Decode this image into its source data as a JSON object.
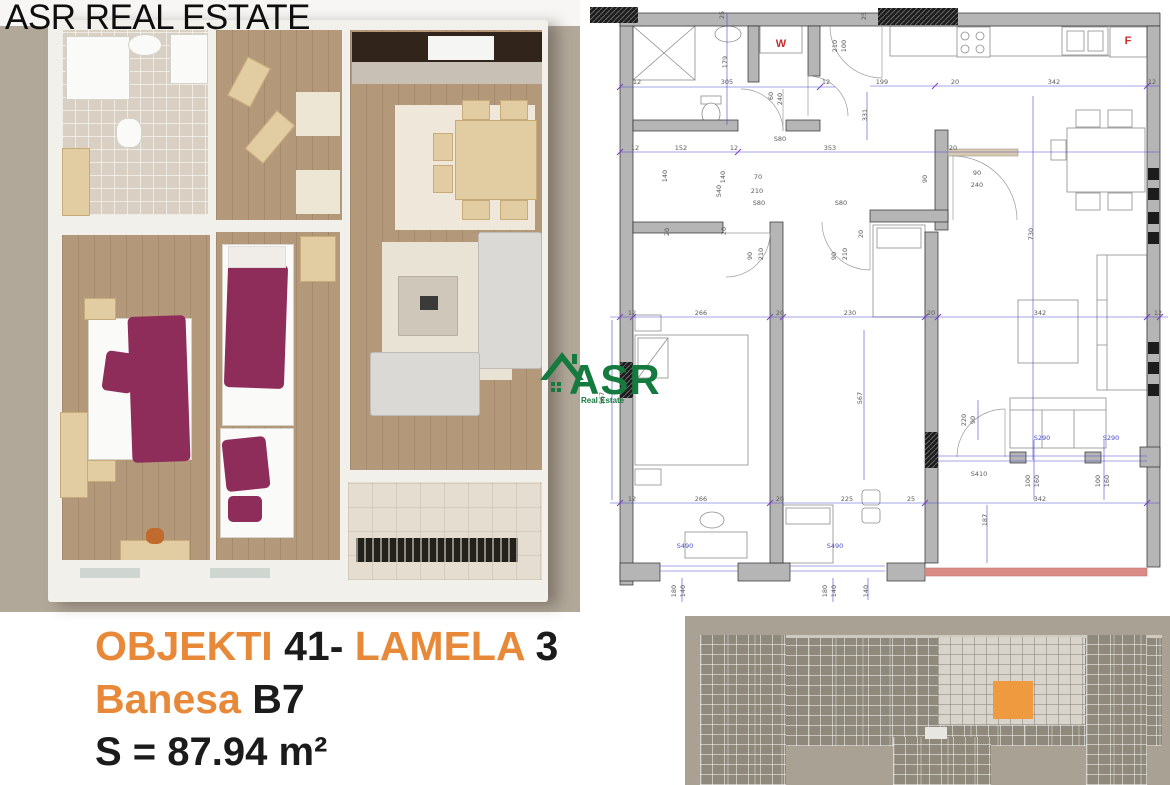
{
  "watermark": {
    "text": "ASR REAL ESTATE"
  },
  "logo": {
    "title": "ASR",
    "subtitle": "Real Estate"
  },
  "caption": {
    "line1": {
      "objekti": "OBJEKTI",
      "num": "41-",
      "lamela": "LAMELA",
      "lamela_num": "3"
    },
    "line2": {
      "label": "Banesa",
      "unit": "B7"
    },
    "area": "S = 87.94 m²"
  },
  "colors": {
    "accent_orange": "#E8893A",
    "logo_green": "#157A3E",
    "highlighted_unit_orange": "#F09A40",
    "dim_blue": "#4B4BCC",
    "plan_label_red": "#CC2B2B",
    "terrace_edge_red": "#D98C85"
  },
  "tech_plan": {
    "appliance_labels": [
      {
        "t": "W",
        "x": 191,
        "y": 47
      },
      {
        "t": "F",
        "x": 538,
        "y": 44
      }
    ],
    "dim_labels": [
      {
        "t": "12",
        "x": 47,
        "y": 84
      },
      {
        "t": "305",
        "x": 137,
        "y": 84
      },
      {
        "t": "12",
        "x": 236,
        "y": 84
      },
      {
        "t": "25",
        "x": 134,
        "y": 15,
        "r": -90
      },
      {
        "t": "179",
        "x": 137,
        "y": 62,
        "r": -90
      },
      {
        "t": "60",
        "x": 183,
        "y": 96,
        "r": -90
      },
      {
        "t": "240",
        "x": 192,
        "y": 99,
        "r": -90
      },
      {
        "t": "12",
        "x": 45,
        "y": 150
      },
      {
        "t": "152",
        "x": 91,
        "y": 150
      },
      {
        "t": "12",
        "x": 144,
        "y": 150
      },
      {
        "t": "353",
        "x": 240,
        "y": 150
      },
      {
        "t": "140",
        "x": 77,
        "y": 176,
        "r": -90
      },
      {
        "t": "140",
        "x": 135,
        "y": 177,
        "r": -90
      },
      {
        "t": "S80",
        "x": 190,
        "y": 141
      },
      {
        "t": "70",
        "x": 168,
        "y": 179
      },
      {
        "t": "210",
        "x": 167,
        "y": 193
      },
      {
        "t": "540",
        "x": 131,
        "y": 191,
        "r": -90
      },
      {
        "t": "S80",
        "x": 169,
        "y": 205
      },
      {
        "t": "S80",
        "x": 251,
        "y": 205
      },
      {
        "t": "20",
        "x": 79,
        "y": 232,
        "r": -90
      },
      {
        "t": "20",
        "x": 136,
        "y": 231,
        "r": -90
      },
      {
        "t": "20",
        "x": 273,
        "y": 234,
        "r": -90
      },
      {
        "t": "90",
        "x": 162,
        "y": 256,
        "r": -90
      },
      {
        "t": "210",
        "x": 173,
        "y": 254,
        "r": -90
      },
      {
        "t": "90",
        "x": 246,
        "y": 256,
        "r": -90
      },
      {
        "t": "210",
        "x": 257,
        "y": 254,
        "r": -90
      },
      {
        "t": "199",
        "x": 292,
        "y": 84
      },
      {
        "t": "20",
        "x": 365,
        "y": 84
      },
      {
        "t": "342",
        "x": 464,
        "y": 84
      },
      {
        "t": "12",
        "x": 562,
        "y": 84
      },
      {
        "t": "25",
        "x": 276,
        "y": 16,
        "r": -90
      },
      {
        "t": "210",
        "x": 247,
        "y": 46,
        "r": -90
      },
      {
        "t": "100",
        "x": 256,
        "y": 46,
        "r": -90
      },
      {
        "t": "331",
        "x": 277,
        "y": 115,
        "r": -90
      },
      {
        "t": "20",
        "x": 363,
        "y": 150
      },
      {
        "t": "90",
        "x": 337,
        "y": 179,
        "r": -90
      },
      {
        "t": "90",
        "x": 387,
        "y": 175
      },
      {
        "t": "240",
        "x": 387,
        "y": 187
      },
      {
        "t": "730",
        "x": 443,
        "y": 234,
        "r": -90
      },
      {
        "t": "12",
        "x": 42,
        "y": 315
      },
      {
        "t": "266",
        "x": 111,
        "y": 315
      },
      {
        "t": "20",
        "x": 190,
        "y": 315
      },
      {
        "t": "230",
        "x": 260,
        "y": 315
      },
      {
        "t": "20",
        "x": 341,
        "y": 315
      },
      {
        "t": "342",
        "x": 450,
        "y": 315
      },
      {
        "t": "12",
        "x": 568,
        "y": 315
      },
      {
        "t": "567",
        "x": 14,
        "y": 398,
        "r": -90
      },
      {
        "t": "567",
        "x": 272,
        "y": 398,
        "r": -90
      },
      {
        "t": "12",
        "x": 42,
        "y": 501
      },
      {
        "t": "266",
        "x": 111,
        "y": 501
      },
      {
        "t": "20",
        "x": 190,
        "y": 501
      },
      {
        "t": "225",
        "x": 257,
        "y": 501
      },
      {
        "t": "25",
        "x": 321,
        "y": 501
      },
      {
        "t": "342",
        "x": 450,
        "y": 501
      },
      {
        "t": "187",
        "x": 397,
        "y": 520,
        "r": -90
      },
      {
        "t": "S490",
        "x": 95,
        "y": 548,
        "c": "b"
      },
      {
        "t": "S490",
        "x": 245,
        "y": 548,
        "c": "b"
      },
      {
        "t": "180",
        "x": 86,
        "y": 591,
        "r": -90
      },
      {
        "t": "140",
        "x": 95,
        "y": 591,
        "r": -90
      },
      {
        "t": "180",
        "x": 237,
        "y": 591,
        "r": -90
      },
      {
        "t": "140",
        "x": 246,
        "y": 591,
        "r": -90
      },
      {
        "t": "140",
        "x": 278,
        "y": 591,
        "r": -90
      },
      {
        "t": "220",
        "x": 376,
        "y": 420,
        "r": -90
      },
      {
        "t": "90",
        "x": 385,
        "y": 420,
        "r": -90
      },
      {
        "t": "S410",
        "x": 389,
        "y": 476
      },
      {
        "t": "S290",
        "x": 452,
        "y": 440,
        "c": "b"
      },
      {
        "t": "S290",
        "x": 521,
        "y": 440,
        "c": "b"
      },
      {
        "t": "100",
        "x": 440,
        "y": 481,
        "r": -90
      },
      {
        "t": "160",
        "x": 449,
        "y": 481,
        "r": -90
      },
      {
        "t": "100",
        "x": 510,
        "y": 481,
        "r": -90
      },
      {
        "t": "160",
        "x": 519,
        "y": 481,
        "r": -90
      }
    ]
  }
}
